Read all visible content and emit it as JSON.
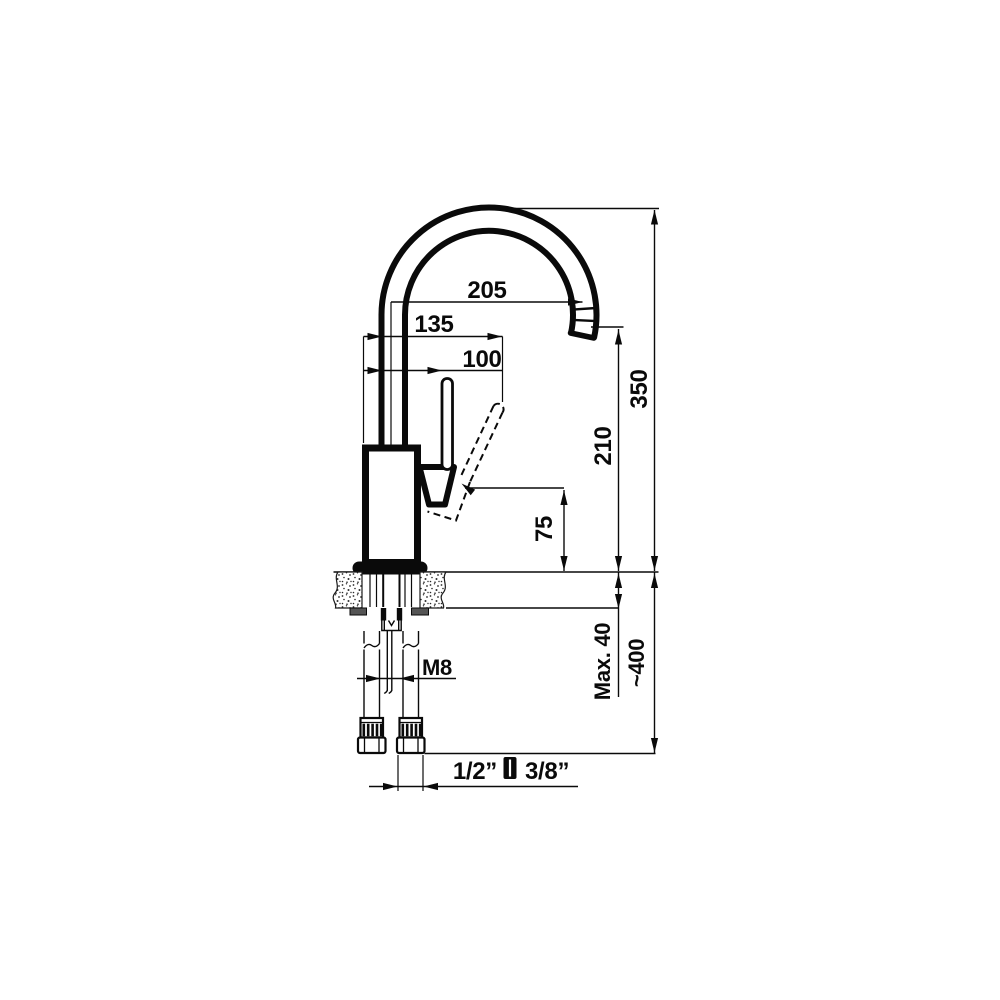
{
  "drawing": {
    "dimensions": {
      "spout_reach": "205",
      "handle_open_reach": "135",
      "handle_reach": "100",
      "total_height": "350",
      "spout_outlet_height": "210",
      "handle_raise_height": "75",
      "max_counter_thickness": "Max. 40",
      "hose_length": "~400",
      "stud_thread": "M8",
      "connection_size_primary": "1/2”",
      "connection_size_secondary": "3/8”"
    },
    "icons": {
      "connection_separator": "thread-size-separator-icon"
    },
    "colors": {
      "line": "#0a0a0a",
      "background": "#ffffff",
      "hardware_fill": "#555555"
    }
  }
}
